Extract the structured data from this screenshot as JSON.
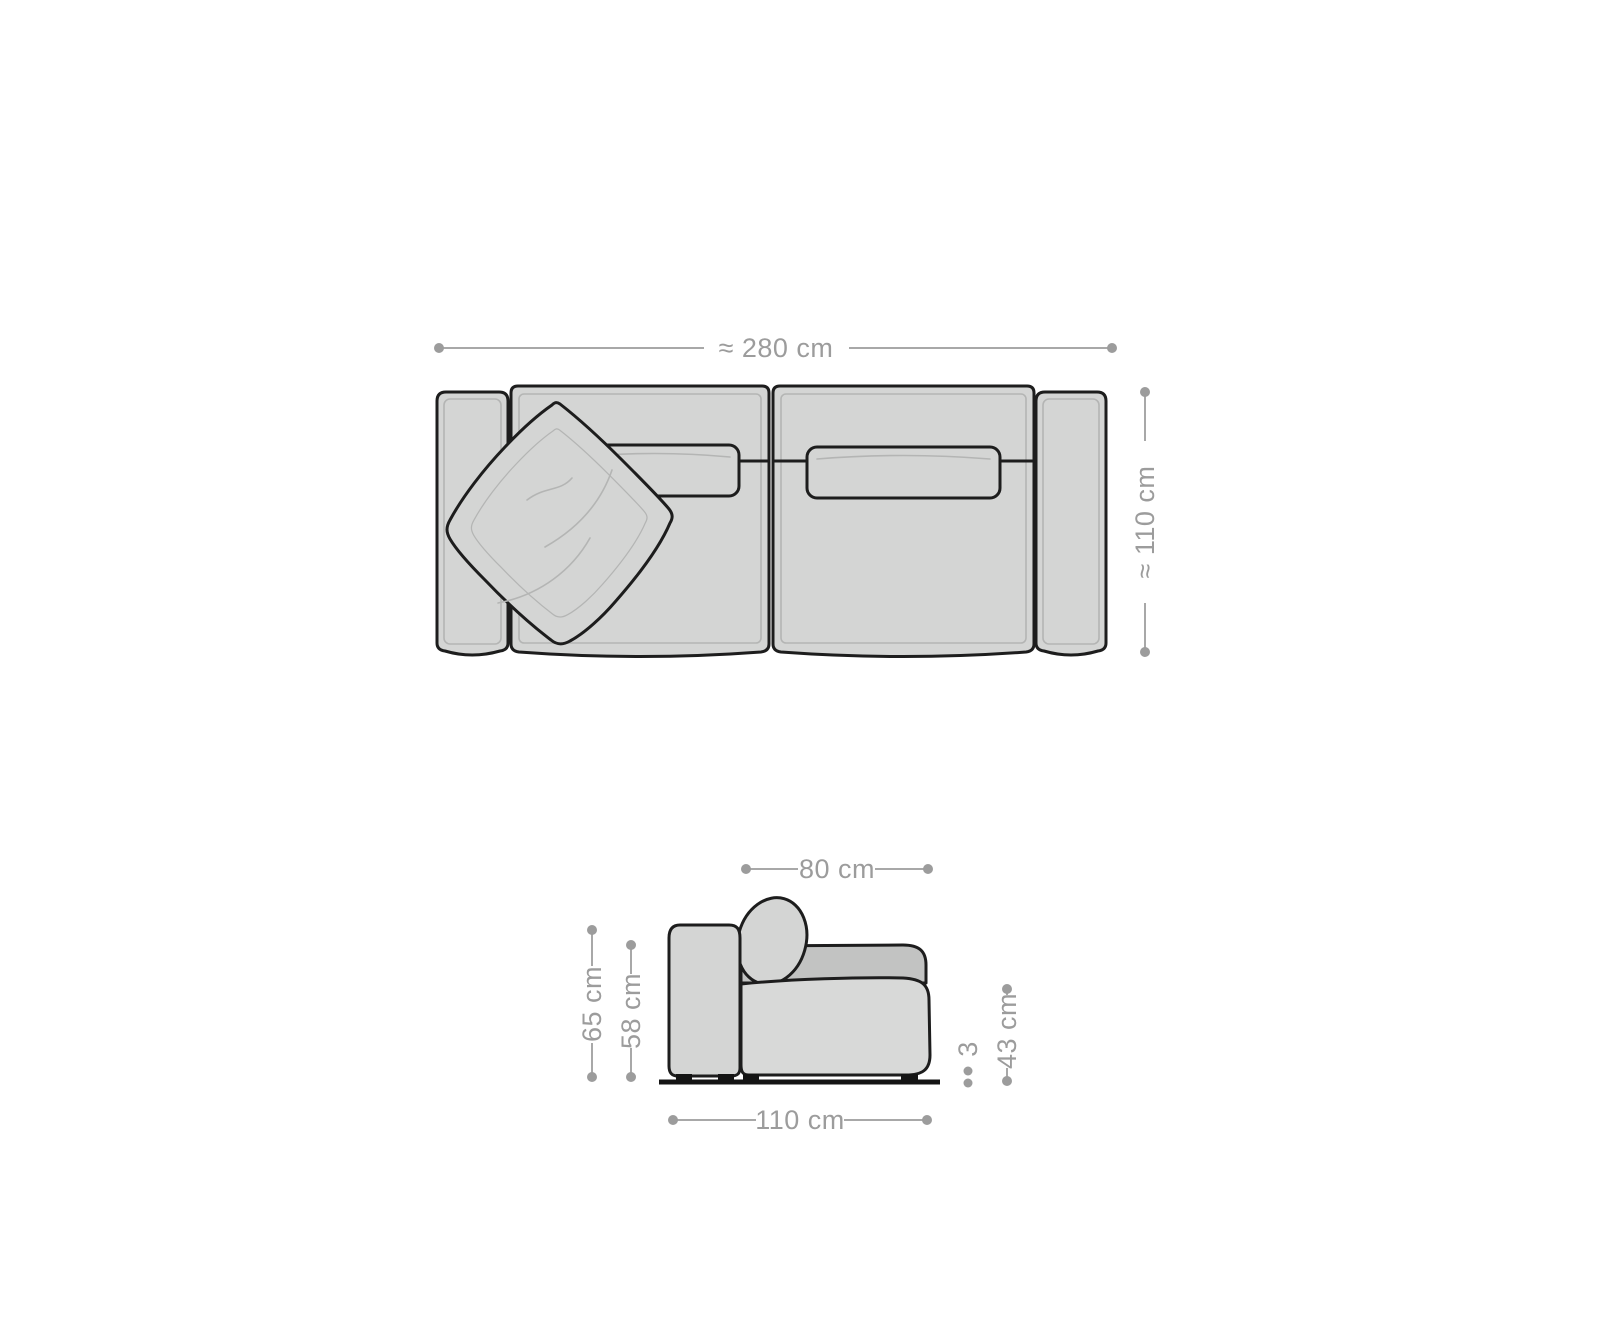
{
  "diagram": {
    "item": "sofa",
    "views": {
      "top": "top-view",
      "side": "side-view"
    },
    "colors": {
      "background": "#ffffff",
      "outline": "#1d1d1d",
      "body_fill": "#d4d5d4",
      "seat_fill": "#d8d9d8",
      "back_cushion_fill": "#c2c3c2",
      "detail_line": "#b4b5b4",
      "dimension_gray": "#9c9c9c",
      "ground_black": "#141414"
    },
    "top_view": {
      "width": {
        "label": "≈ 280 cm"
      },
      "depth": {
        "label": "≈ 110 cm"
      }
    },
    "side_view": {
      "seat_depth": {
        "label": "80 cm"
      },
      "armrest_height": {
        "label": "65 cm"
      },
      "back_height": {
        "label": "58 cm"
      },
      "seat_height": {
        "label": "43 cm"
      },
      "feet_height": {
        "label": "3"
      },
      "total_depth": {
        "label": "110 cm"
      }
    }
  }
}
